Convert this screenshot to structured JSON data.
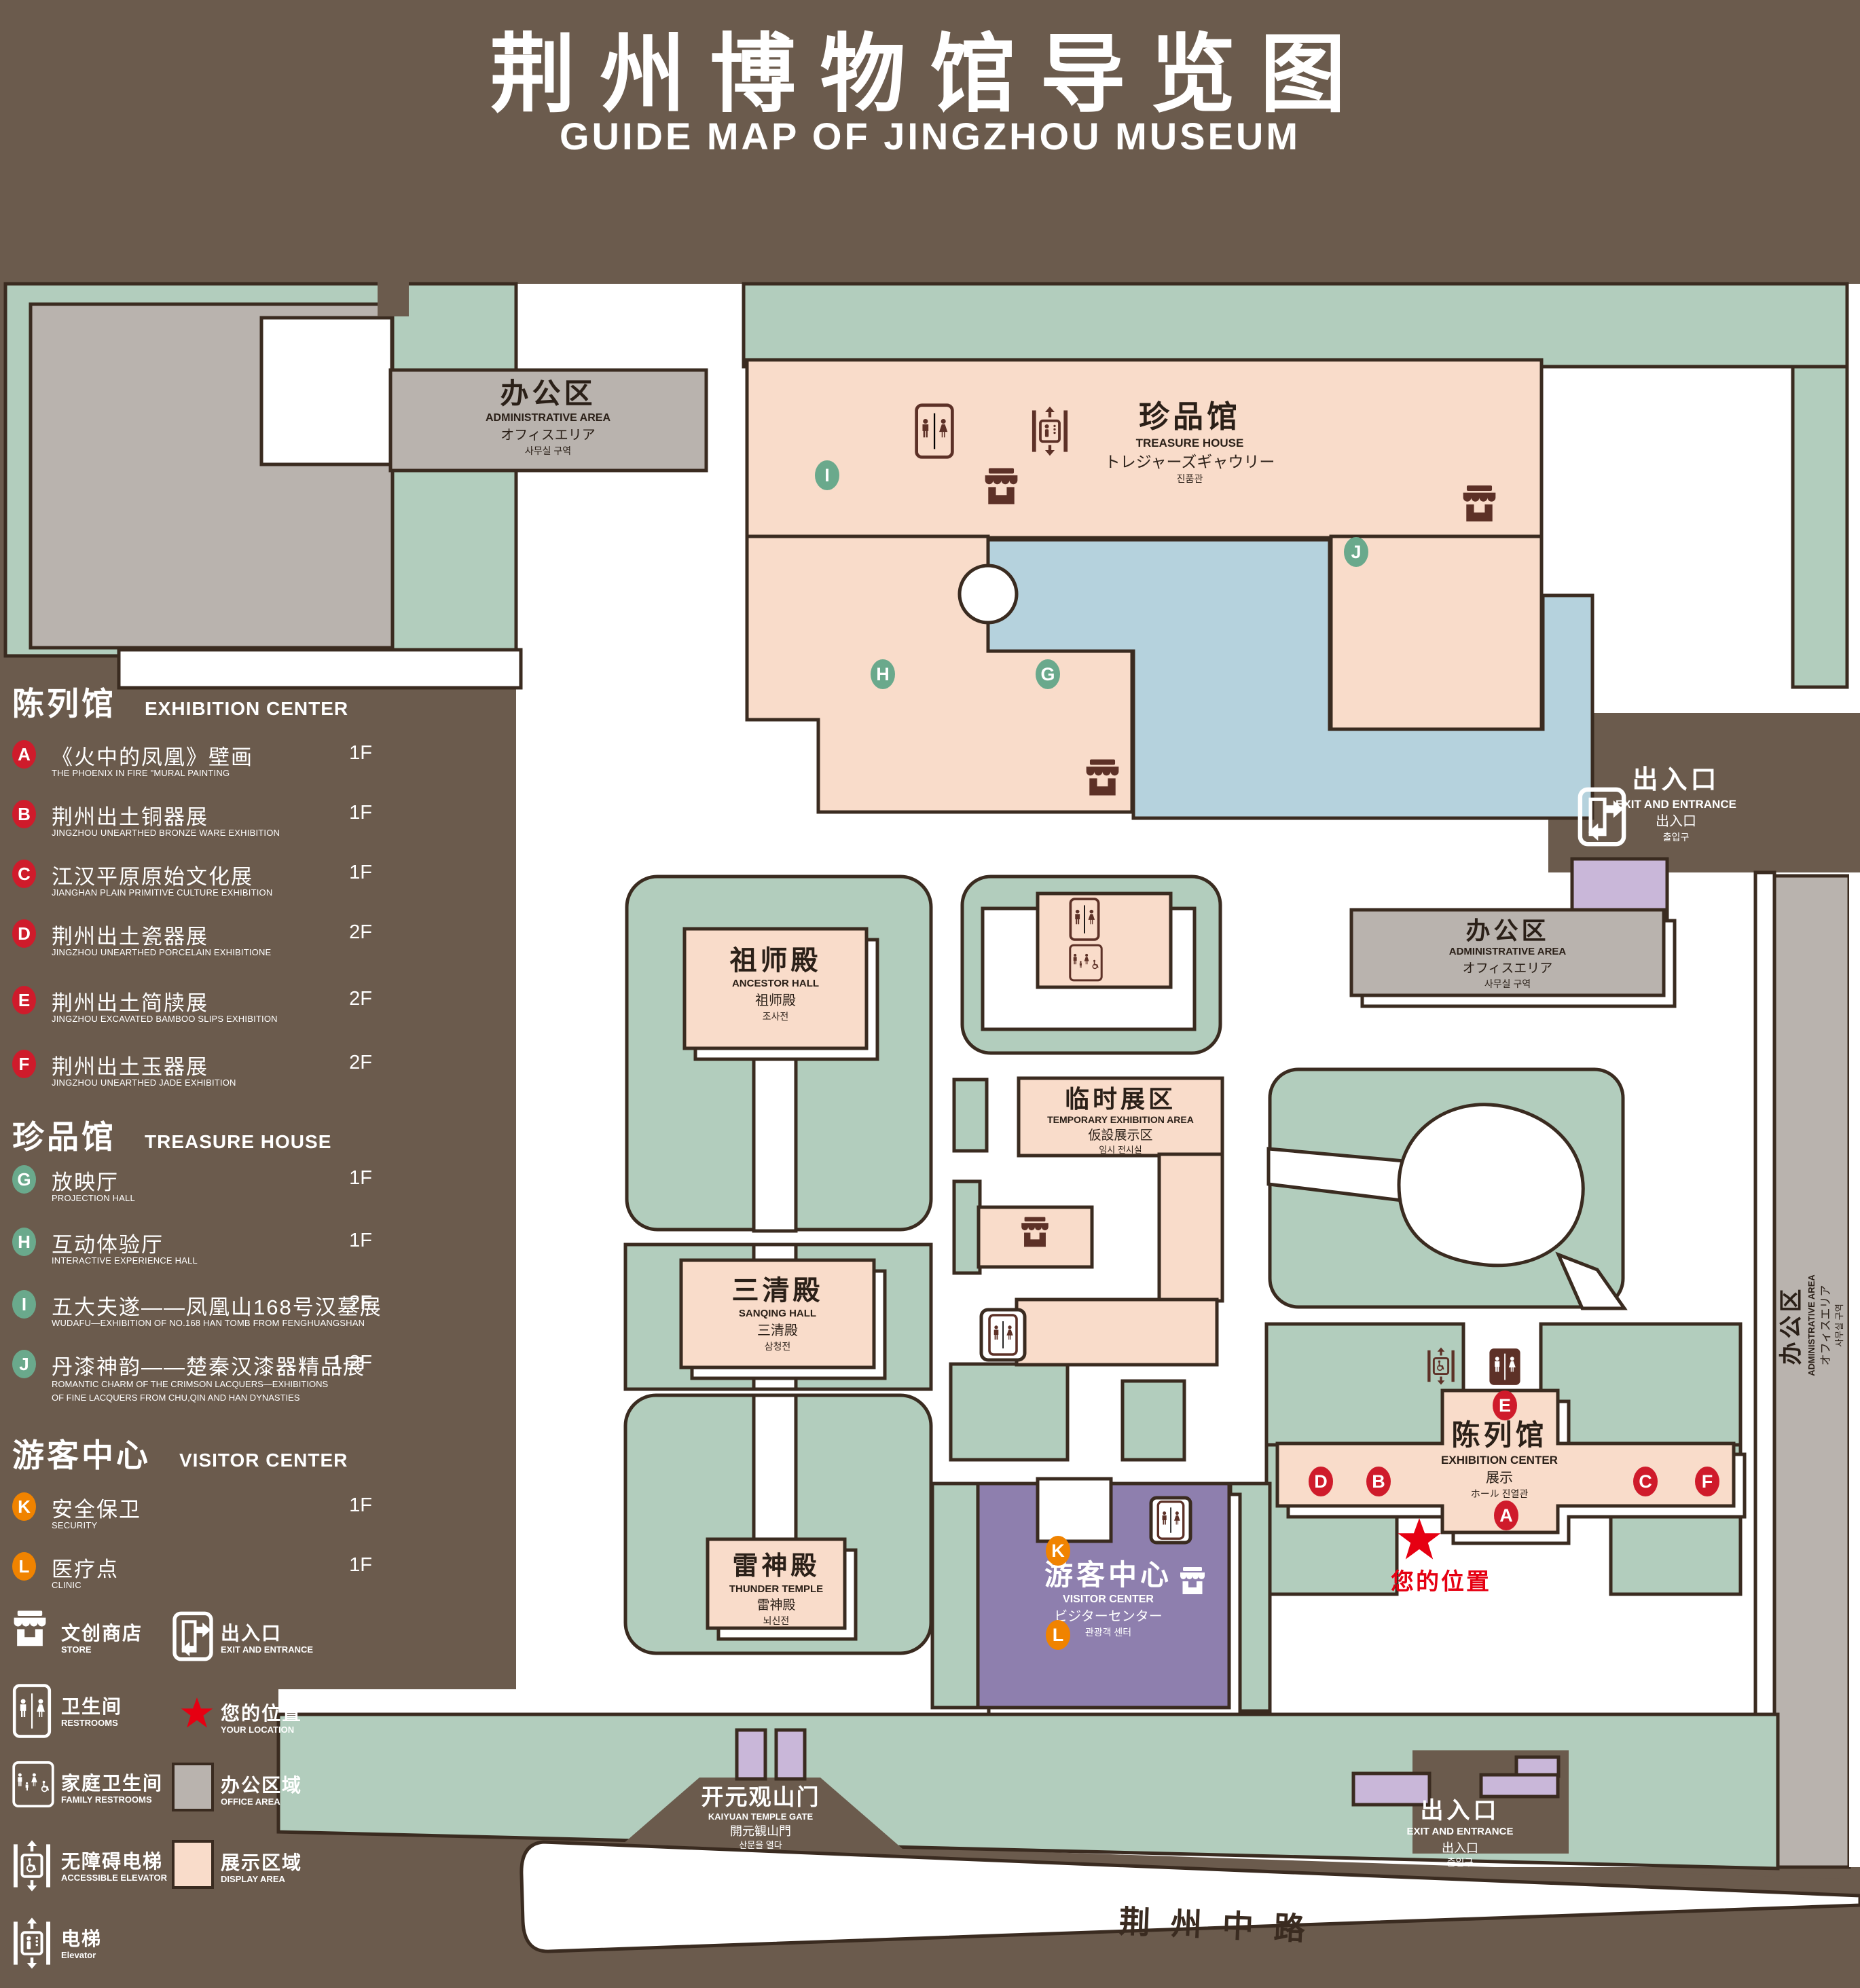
{
  "title": {
    "zh": "荆州博物馆导览图",
    "en": "GUIDE MAP OF JINGZHOU MUSEUM"
  },
  "legend": {
    "sections": [
      {
        "zh": "陈列馆",
        "en": "EXHIBITION CENTER",
        "items": [
          {
            "letter": "A",
            "zh": "《火中的凤凰》壁画",
            "en": "THE PHOENIX IN FIRE \"MURAL PAINTING",
            "floor": "1F"
          },
          {
            "letter": "B",
            "zh": "荆州出土铜器展",
            "en": "JINGZHOU UNEARTHED BRONZE WARE EXHIBITION",
            "floor": "1F"
          },
          {
            "letter": "C",
            "zh": "江汉平原原始文化展",
            "en": "JIANGHAN PLAIN PRIMITIVE CULTURE EXHIBITION",
            "floor": "1F"
          },
          {
            "letter": "D",
            "zh": "荆州出土瓷器展",
            "en": "JINGZHOU UNEARTHED PORCELAIN EXHIBITIONE",
            "floor": "2F"
          },
          {
            "letter": "E",
            "zh": "荆州出土简牍展",
            "en": "JINGZHOU EXCAVATED BAMBOO SLIPS EXHIBITION",
            "floor": "2F"
          },
          {
            "letter": "F",
            "zh": "荆州出土玉器展",
            "en": "JINGZHOU UNEARTHED JADE EXHIBITION",
            "floor": "2F"
          }
        ]
      },
      {
        "zh": "珍品馆",
        "en": "TREASURE HOUSE",
        "items": [
          {
            "letter": "G",
            "zh": "放映厅",
            "en": "PROJECTION HALL",
            "floor": "1F"
          },
          {
            "letter": "H",
            "zh": "互动体验厅",
            "en": "INTERACTIVE EXPERIENCE HALL",
            "floor": "1F"
          },
          {
            "letter": "I",
            "zh": "五大夫遂——凤凰山168号汉墓展",
            "en": "WUDAFU—EXHIBITION OF NO.168 HAN TOMB FROM FENGHUANGSHAN",
            "floor": "2F"
          },
          {
            "letter": "J",
            "zh": "丹漆神韵——楚秦汉漆器精品展",
            "en_line1": "ROMANTIC CHARM OF THE CRIMSON LACQUERS—EXHIBITIONS",
            "en_line2": "OF FINE LACQUERS FROM CHU,QIN AND HAN DYNASTIES",
            "floor": "1-2F"
          }
        ]
      },
      {
        "zh": "游客中心",
        "en": "VISITOR CENTER",
        "items": [
          {
            "letter": "K",
            "zh": "安全保卫",
            "en": "SECURITY",
            "floor": "1F"
          },
          {
            "letter": "L",
            "zh": "医疗点",
            "en": "CLINIC",
            "floor": "1F"
          }
        ]
      }
    ],
    "symbols": [
      {
        "icon": "store-icon",
        "zh": "文创商店",
        "en": "STORE"
      },
      {
        "icon": "exit-entrance-icon",
        "zh": "出入口",
        "en": "EXIT AND ENTRANCE"
      },
      {
        "icon": "restrooms-icon",
        "zh": "卫生间",
        "en": "RESTROOMS"
      },
      {
        "icon": "your-location-icon",
        "zh": "您的位置",
        "en": "YOUR LOCATION"
      },
      {
        "icon": "family-restrooms-icon",
        "zh": "家庭卫生间",
        "en": "FAMILY RESTROOMS"
      },
      {
        "icon": "office-area-swatch",
        "zh": "办公区域",
        "en": "OFFICE AREA"
      },
      {
        "icon": "accessible-elevator-icon",
        "zh": "无障碍电梯",
        "en": "ACCESSIBLE ELEVATOR"
      },
      {
        "icon": "display-area-swatch",
        "zh": "展示区域",
        "en": "DISPLAY AREA"
      },
      {
        "icon": "elevator-icon",
        "zh": "电梯",
        "en": "Elevator"
      }
    ]
  },
  "map": {
    "buildings": {
      "admin_top": {
        "zh": "办公区",
        "en": "ADMINISTRATIVE AREA",
        "ja": "オフィスエリア",
        "ko": "사무실 구역"
      },
      "treasure": {
        "zh": "珍品馆",
        "en": "TREASURE HOUSE",
        "ja": "トレジャーズギャウリー",
        "ko": "진품관"
      },
      "admin_right": {
        "zh": "办公区",
        "en": "ADMINISTRATIVE AREA",
        "ja": "オフィスエリア",
        "ko": "사무실 구역"
      },
      "admin_side": {
        "zh": "办公区",
        "en": "ADMINISTRATIVE AREA",
        "ja": "オフィスエリア",
        "ko": "사무실 구역"
      },
      "ancestor": {
        "zh": "祖师殿",
        "en": "ANCESTOR HALL",
        "ja": "祖师殿",
        "ko": "조사전"
      },
      "temporary": {
        "zh": "临时展区",
        "en": "TEMPORARY EXHIBITION AREA",
        "ja": "仮設展示区",
        "ko": "임시 전시실"
      },
      "sanqing": {
        "zh": "三清殿",
        "en": "SANQING HALL",
        "ja": "三清殿",
        "ko": "삼청전"
      },
      "thunder": {
        "zh": "雷神殿",
        "en": "THUNDER TEMPLE",
        "ja": "雷神殿",
        "ko": "뇌신전"
      },
      "visitor": {
        "zh": "游客中心",
        "en": "VISITOR CENTER",
        "ja": "ビジターセンター",
        "ko": "관광객 센터"
      },
      "exhibition": {
        "zh": "陈列馆",
        "en": "EXHIBITION CENTER",
        "ja": "展示",
        "ko": "ホール 진열관"
      },
      "gate": {
        "zh": "开元观山门",
        "en": "KAIYUAN TEMPLE GATE",
        "ja": "開元観山門",
        "ko": "산문을 열다"
      }
    },
    "exit": {
      "zh": "出入口",
      "en": "EXIT AND ENTRANCE",
      "ja": "出入口",
      "ko": "출입구"
    },
    "road": {
      "name": "荆州中路"
    },
    "your_location": {
      "zh": "您的位置"
    },
    "markers": [
      {
        "letter": "A"
      },
      {
        "letter": "B"
      },
      {
        "letter": "C"
      },
      {
        "letter": "D"
      },
      {
        "letter": "E"
      },
      {
        "letter": "F"
      },
      {
        "letter": "G"
      },
      {
        "letter": "H"
      },
      {
        "letter": "I"
      },
      {
        "letter": "J"
      },
      {
        "letter": "K"
      },
      {
        "letter": "L"
      }
    ]
  },
  "colors": {
    "background": "#6b5b4d",
    "outline": "#3a2b20",
    "lawn_green": "#b2cdbd",
    "display_pink": "#f9dcca",
    "office_gray": "#b9b3ae",
    "pond_blue": "#b5d2dd",
    "visitor_purple": "#8e7fae",
    "gate_purple": "#c9b7d9",
    "badge_red": "#cf1b2b",
    "badge_green": "#6aa98c",
    "badge_orange": "#f08300",
    "icon_brown": "#5d3127",
    "location_red": "#e60012"
  }
}
